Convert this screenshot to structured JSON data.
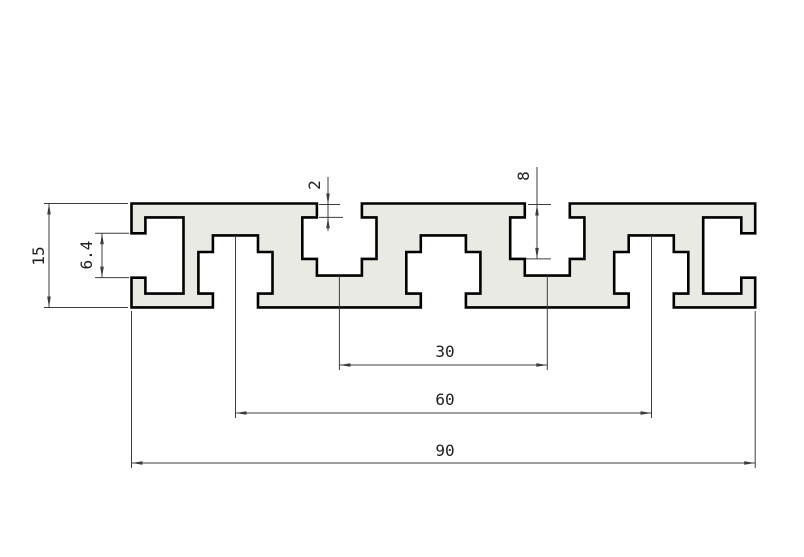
{
  "canvas": {
    "width": 804,
    "height": 557,
    "background": "#ffffff"
  },
  "colors": {
    "profile_fill": "#eaeae4",
    "profile_stroke": "#000000",
    "dim_line": "#3c3c3c",
    "text": "#1f1f1f"
  },
  "drawing": {
    "kind": "aluminum-extrusion-profile-cross-section",
    "scale_px_per_mm": 6.93,
    "origin_px": {
      "x": 131.5,
      "y": 203.5
    },
    "profile": {
      "overall_width_mm": 90,
      "overall_height_mm": 15,
      "top_slot_centers_mm": [
        30,
        60
      ],
      "bottom_slot_centers_mm": [
        15,
        45,
        75
      ],
      "end_slot_opening_mm": 6.4,
      "slot_neck_depth_mm": 2,
      "slot_depth_mm": 8,
      "outline_mm": [
        [
          0,
          0
        ],
        [
          26.75,
          0
        ],
        [
          26.75,
          2
        ],
        [
          24.65,
          2
        ],
        [
          24.65,
          8
        ],
        [
          26.75,
          8
        ],
        [
          26.75,
          10.4
        ],
        [
          33.25,
          10.4
        ],
        [
          33.25,
          8
        ],
        [
          35.35,
          8
        ],
        [
          35.35,
          2
        ],
        [
          33.25,
          2
        ],
        [
          33.25,
          0
        ],
        [
          56.75,
          0
        ],
        [
          56.75,
          2
        ],
        [
          54.65,
          2
        ],
        [
          54.65,
          8
        ],
        [
          56.75,
          8
        ],
        [
          56.75,
          10.4
        ],
        [
          63.25,
          10.4
        ],
        [
          63.25,
          8
        ],
        [
          65.35,
          8
        ],
        [
          65.35,
          2
        ],
        [
          63.25,
          2
        ],
        [
          63.25,
          0
        ],
        [
          90,
          0
        ],
        [
          90,
          4.3
        ],
        [
          88,
          4.3
        ],
        [
          88,
          2
        ],
        [
          82.5,
          2
        ],
        [
          82.5,
          13
        ],
        [
          88,
          13
        ],
        [
          88,
          10.7
        ],
        [
          90,
          10.7
        ],
        [
          90,
          15
        ],
        [
          78.25,
          15
        ],
        [
          78.25,
          13
        ],
        [
          80.35,
          13
        ],
        [
          80.35,
          7
        ],
        [
          78.25,
          7
        ],
        [
          78.25,
          4.6
        ],
        [
          71.75,
          4.6
        ],
        [
          71.75,
          7
        ],
        [
          69.65,
          7
        ],
        [
          69.65,
          13
        ],
        [
          71.75,
          13
        ],
        [
          71.75,
          15
        ],
        [
          48.25,
          15
        ],
        [
          48.25,
          13
        ],
        [
          50.35,
          13
        ],
        [
          50.35,
          7
        ],
        [
          48.25,
          7
        ],
        [
          48.25,
          4.6
        ],
        [
          41.75,
          4.6
        ],
        [
          41.75,
          7
        ],
        [
          39.65,
          7
        ],
        [
          39.65,
          13
        ],
        [
          41.75,
          13
        ],
        [
          41.75,
          15
        ],
        [
          18.25,
          15
        ],
        [
          18.25,
          13
        ],
        [
          20.35,
          13
        ],
        [
          20.35,
          7
        ],
        [
          18.25,
          7
        ],
        [
          18.25,
          4.6
        ],
        [
          11.75,
          4.6
        ],
        [
          11.75,
          7
        ],
        [
          9.65,
          7
        ],
        [
          9.65,
          13
        ],
        [
          11.75,
          13
        ],
        [
          11.75,
          15
        ],
        [
          0,
          15
        ],
        [
          0,
          10.7
        ],
        [
          2,
          10.7
        ],
        [
          2,
          13
        ],
        [
          7.5,
          13
        ],
        [
          7.5,
          2
        ],
        [
          2,
          2
        ],
        [
          2,
          4.3
        ],
        [
          0,
          4.3
        ]
      ]
    },
    "dimensions": [
      {
        "label": "15",
        "value_mm": 15,
        "measures": "overall-height",
        "line": {
          "x1": 49,
          "y1": 203.5,
          "x2": 49,
          "y2": 307.5
        },
        "arrows": [
          {
            "x": 49,
            "y": 203.5,
            "dir": "up"
          },
          {
            "x": 49,
            "y": 307.5,
            "dir": "down"
          }
        ],
        "ext": [
          {
            "x1": 44,
            "y1": 203.5,
            "x2": 128,
            "y2": 203.5
          },
          {
            "x1": 44,
            "y1": 307.5,
            "x2": 128,
            "y2": 307.5
          }
        ],
        "text": {
          "x": 44,
          "y": 256,
          "rotate": -90
        }
      },
      {
        "label": "6.4",
        "value_mm": 6.4,
        "measures": "end-slot-opening-height",
        "line": {
          "x1": 102,
          "y1": 233.3,
          "x2": 102,
          "y2": 277.6
        },
        "arrows": [
          {
            "x": 102,
            "y": 233.3,
            "dir": "up"
          },
          {
            "x": 102,
            "y": 277.6,
            "dir": "down"
          }
        ],
        "ext": [
          {
            "x1": 95,
            "y1": 233.3,
            "x2": 129,
            "y2": 233.3
          },
          {
            "x1": 95,
            "y1": 277.6,
            "x2": 129,
            "y2": 277.6
          }
        ],
        "text": {
          "x": 92,
          "y": 255,
          "rotate": -90
        }
      },
      {
        "label": "2",
        "value_mm": 2,
        "measures": "slot-neck-depth",
        "line": {
          "x1": 328,
          "y1": 177,
          "x2": 328,
          "y2": 231
        },
        "arrows": [
          {
            "x": 328,
            "y": 204.5,
            "dir": "down"
          },
          {
            "x": 328,
            "y": 217.4,
            "dir": "up"
          }
        ],
        "ext": [
          {
            "x1": 319,
            "y1": 204.5,
            "x2": 340,
            "y2": 204.5
          },
          {
            "x1": 319,
            "y1": 217.4,
            "x2": 343,
            "y2": 217.4
          }
        ],
        "text": {
          "x": 320,
          "y": 185,
          "rotate": -90
        }
      },
      {
        "label": "8",
        "value_mm": 8,
        "measures": "slot-depth",
        "line": {
          "x1": 537,
          "y1": 167,
          "x2": 537,
          "y2": 258.9
        },
        "arrows": [
          {
            "x": 537,
            "y": 204.5,
            "dir": "up"
          },
          {
            "x": 537,
            "y": 258.9,
            "dir": "down"
          }
        ],
        "ext": [
          {
            "x1": 528,
            "y1": 204.5,
            "x2": 551,
            "y2": 204.5
          },
          {
            "x1": 526,
            "y1": 258.9,
            "x2": 551,
            "y2": 258.9
          }
        ],
        "text": {
          "x": 529,
          "y": 176,
          "rotate": -90
        }
      },
      {
        "label": "30",
        "value_mm": 30,
        "measures": "top-slot-spacing",
        "line": {
          "x1": 339.4,
          "y1": 365,
          "x2": 547.3,
          "y2": 365
        },
        "arrows": [
          {
            "x": 339.4,
            "y": 365,
            "dir": "left"
          },
          {
            "x": 547.3,
            "y": 365,
            "dir": "right"
          }
        ],
        "ext": [
          {
            "x1": 339.4,
            "y1": 275.6,
            "x2": 339.4,
            "y2": 370
          },
          {
            "x1": 547.3,
            "y1": 275.6,
            "x2": 547.3,
            "y2": 370
          }
        ],
        "text": {
          "x": 445,
          "y": 357,
          "rotate": 0
        }
      },
      {
        "label": "60",
        "value_mm": 60,
        "measures": "bottom-slot-spacing",
        "line": {
          "x1": 235.5,
          "y1": 413,
          "x2": 651.5,
          "y2": 413
        },
        "arrows": [
          {
            "x": 235.5,
            "y": 413,
            "dir": "left"
          },
          {
            "x": 651.5,
            "y": 413,
            "dir": "right"
          }
        ],
        "ext": [
          {
            "x1": 235.5,
            "y1": 235.4,
            "x2": 235.5,
            "y2": 418
          },
          {
            "x1": 651.5,
            "y1": 235.4,
            "x2": 651.5,
            "y2": 418
          }
        ],
        "text": {
          "x": 445,
          "y": 405,
          "rotate": 0
        }
      },
      {
        "label": "90",
        "value_mm": 90,
        "measures": "overall-width",
        "line": {
          "x1": 131.5,
          "y1": 463,
          "x2": 755.2,
          "y2": 463
        },
        "arrows": [
          {
            "x": 131.5,
            "y": 463,
            "dir": "left"
          },
          {
            "x": 755.2,
            "y": 463,
            "dir": "right"
          }
        ],
        "ext": [
          {
            "x1": 131.5,
            "y1": 311,
            "x2": 131.5,
            "y2": 468
          },
          {
            "x1": 755.2,
            "y1": 311,
            "x2": 755.2,
            "y2": 468
          }
        ],
        "text": {
          "x": 445,
          "y": 456,
          "rotate": 0
        }
      }
    ]
  }
}
